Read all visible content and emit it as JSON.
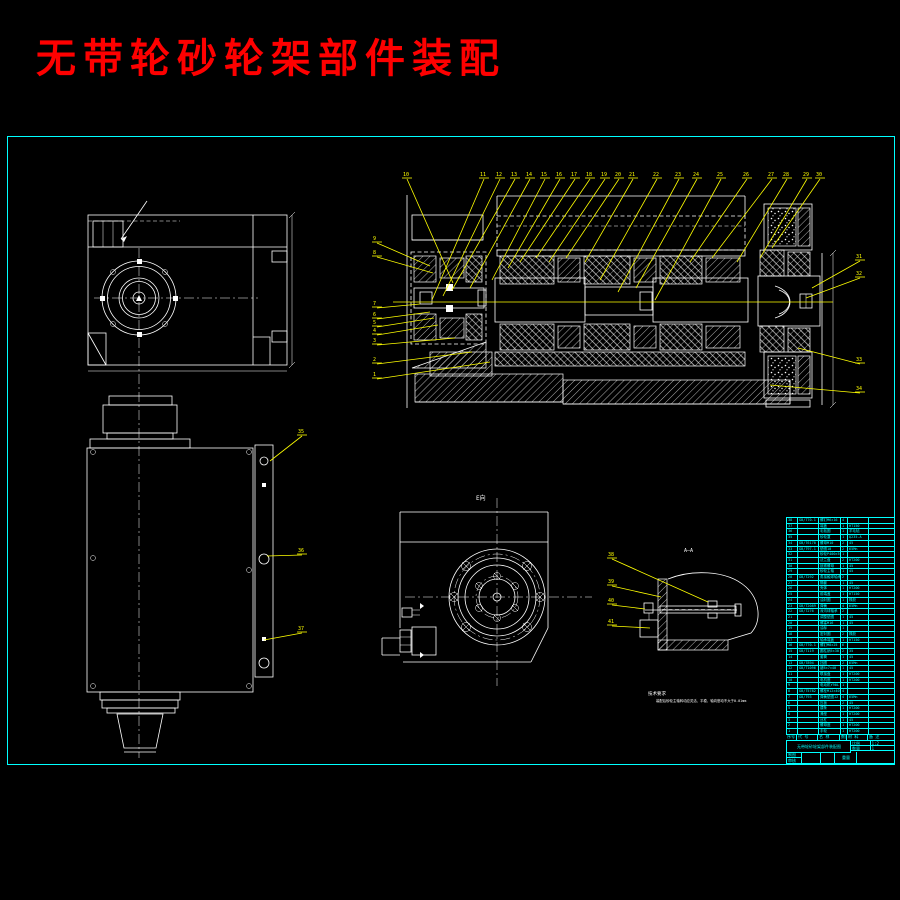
{
  "title": {
    "text": "无带轮砂轮架部件装配"
  },
  "labels": {
    "e_view": "E向",
    "section_aa": "A—A"
  },
  "notes": {
    "heading": "技术要求",
    "body": "装配后砂轮主轴转动应灵活、平稳，轴向窜动不大于0.01mm"
  },
  "colors": {
    "accent": "#ffff00",
    "frame": "#00ffff",
    "line": "#ffffff",
    "title": "#fe0000"
  },
  "bom": {
    "headers": [
      "序号",
      "代 号",
      "名 称",
      "数量",
      "材 料",
      "备 注"
    ],
    "rows": [
      [
        "38",
        "GB/T70.1",
        "螺钉M6×16",
        "4",
        "",
        ""
      ],
      [
        "37",
        "",
        "端盖",
        "1",
        "HT150",
        ""
      ],
      [
        "36",
        "",
        "毛毡圈",
        "1",
        "羊毛毡",
        ""
      ],
      [
        "35",
        "",
        "砂轮罩",
        "1",
        "Q235-A",
        ""
      ],
      [
        "34",
        "GB/T6170",
        "螺母M10",
        "2",
        "45",
        ""
      ],
      [
        "33",
        "GB/T97.1",
        "垫圈10",
        "2",
        "65Mn",
        ""
      ],
      [
        "32",
        "",
        "砂轮P400×50",
        "1",
        "",
        ""
      ],
      [
        "31",
        "",
        "法兰盘",
        "2",
        "HT200",
        ""
      ],
      [
        "30",
        "",
        "锁紧螺母",
        "1",
        "45",
        ""
      ],
      [
        "29",
        "",
        "砂轮主轴",
        "1",
        "45",
        ""
      ],
      [
        "28",
        "GB/T292",
        "角接触球轴承",
        "2",
        "",
        ""
      ],
      [
        "27",
        "",
        "隔套",
        "1",
        "45",
        ""
      ],
      [
        "26",
        "",
        "壳体",
        "1",
        "HT200",
        ""
      ],
      [
        "25",
        "",
        "前端盖",
        "1",
        "HT150",
        ""
      ],
      [
        "24",
        "",
        "油封圈",
        "1",
        "橡胶",
        ""
      ],
      [
        "23",
        "GB/T2089",
        "弹簧",
        "4",
        "65Mn",
        ""
      ],
      [
        "22",
        "GB/T276",
        "深沟球轴承",
        "2",
        "",
        ""
      ],
      [
        "21",
        "",
        "调整垫圈",
        "1",
        "45",
        ""
      ],
      [
        "20",
        "",
        "螺塞M16",
        "1",
        "45",
        ""
      ],
      [
        "19",
        "",
        "油标",
        "1",
        "",
        ""
      ],
      [
        "18",
        "",
        "密封圈",
        "2",
        "橡胶",
        ""
      ],
      [
        "17",
        "",
        "轴承端盖",
        "1",
        "HT150",
        ""
      ],
      [
        "16",
        "GB/T70.1",
        "螺钉M8×25",
        "6",
        "",
        ""
      ],
      [
        "15",
        "GB/T119",
        "圆柱销5×30",
        "2",
        "35",
        ""
      ],
      [
        "14",
        "",
        "套筒",
        "1",
        "45",
        ""
      ],
      [
        "13",
        "GB/T894",
        "挡圈",
        "2",
        "65Mn",
        ""
      ],
      [
        "12",
        "GB/T1096",
        "键8×7×40",
        "1",
        "45",
        ""
      ],
      [
        "11",
        "",
        "联接盘",
        "1",
        "HT200",
        ""
      ],
      [
        "10",
        "",
        "电机座",
        "1",
        "HT200",
        ""
      ],
      [
        "9",
        "",
        "电动机Y90L",
        "1",
        "",
        ""
      ],
      [
        "8",
        "GB/T5782",
        "螺栓M12×40",
        "4",
        "",
        ""
      ],
      [
        "7",
        "GB/T93",
        "弹簧垫圈12",
        "4",
        "65Mn",
        ""
      ],
      [
        "6",
        "",
        "压板",
        "2",
        "45",
        ""
      ],
      [
        "5",
        "",
        "镶条",
        "1",
        "HT200",
        ""
      ],
      [
        "4",
        "",
        "滑座",
        "1",
        "HT200",
        ""
      ],
      [
        "3",
        "",
        "丝杠",
        "1",
        "45",
        ""
      ],
      [
        "2",
        "",
        "螺母座",
        "1",
        "HT200",
        ""
      ],
      [
        "1",
        "",
        "手轮",
        "1",
        "HT200",
        ""
      ]
    ],
    "title_block": {
      "title": "无带轮砂轮架部件装配图",
      "scale_label": "比例",
      "scale": "1:2",
      "qty_label": "数量",
      "qty": "1",
      "weight_label": "重量",
      "draw_label": "制图",
      "check_label": "审核"
    }
  },
  "balloons": [
    {
      "n": "10",
      "lx": 403,
      "ly": 176,
      "tx": 453,
      "ty": 283
    },
    {
      "n": "11",
      "lx": 480,
      "ly": 176,
      "tx": 432,
      "ty": 300
    },
    {
      "n": "12",
      "lx": 496,
      "ly": 176,
      "tx": 443,
      "ty": 296
    },
    {
      "n": "13",
      "lx": 511,
      "ly": 176,
      "tx": 452,
      "ty": 290
    },
    {
      "n": "14",
      "lx": 526,
      "ly": 176,
      "tx": 470,
      "ty": 288
    },
    {
      "n": "15",
      "lx": 541,
      "ly": 176,
      "tx": 492,
      "ty": 280
    },
    {
      "n": "16",
      "lx": 556,
      "ly": 176,
      "tx": 508,
      "ty": 268
    },
    {
      "n": "17",
      "lx": 571,
      "ly": 176,
      "tx": 520,
      "ty": 262
    },
    {
      "n": "18",
      "lx": 586,
      "ly": 176,
      "tx": 536,
      "ty": 258
    },
    {
      "n": "19",
      "lx": 601,
      "ly": 176,
      "tx": 549,
      "ty": 262
    },
    {
      "n": "20",
      "lx": 615,
      "ly": 176,
      "tx": 566,
      "ty": 258
    },
    {
      "n": "21",
      "lx": 629,
      "ly": 176,
      "tx": 585,
      "ty": 262
    },
    {
      "n": "22",
      "lx": 653,
      "ly": 176,
      "tx": 600,
      "ty": 280
    },
    {
      "n": "23",
      "lx": 675,
      "ly": 176,
      "tx": 618,
      "ty": 292
    },
    {
      "n": "24",
      "lx": 693,
      "ly": 176,
      "tx": 636,
      "ty": 288
    },
    {
      "n": "25",
      "lx": 717,
      "ly": 176,
      "tx": 655,
      "ty": 300
    },
    {
      "n": "26",
      "lx": 743,
      "ly": 176,
      "tx": 690,
      "ty": 262
    },
    {
      "n": "27",
      "lx": 768,
      "ly": 176,
      "tx": 712,
      "ty": 258
    },
    {
      "n": "28",
      "lx": 783,
      "ly": 176,
      "tx": 737,
      "ty": 262
    },
    {
      "n": "29",
      "lx": 803,
      "ly": 176,
      "tx": 760,
      "ty": 258
    },
    {
      "n": "30",
      "lx": 816,
      "ly": 176,
      "tx": 772,
      "ty": 248
    },
    {
      "n": "9",
      "lx": 373,
      "ly": 240,
      "tx": 430,
      "ty": 266
    },
    {
      "n": "8",
      "lx": 373,
      "ly": 254,
      "tx": 433,
      "ty": 273
    },
    {
      "n": "7",
      "lx": 373,
      "ly": 305,
      "tx": 420,
      "ty": 304
    },
    {
      "n": "6",
      "lx": 373,
      "ly": 316,
      "tx": 430,
      "ty": 312
    },
    {
      "n": "5",
      "lx": 373,
      "ly": 324,
      "tx": 434,
      "ty": 318
    },
    {
      "n": "4",
      "lx": 373,
      "ly": 332,
      "tx": 438,
      "ty": 325
    },
    {
      "n": "3",
      "lx": 373,
      "ly": 342,
      "tx": 455,
      "ty": 338
    },
    {
      "n": "2",
      "lx": 373,
      "ly": 361,
      "tx": 472,
      "ty": 352
    },
    {
      "n": "1",
      "lx": 373,
      "ly": 376,
      "tx": 490,
      "ty": 362
    },
    {
      "n": "31",
      "lx": 856,
      "ly": 258,
      "tx": 812,
      "ty": 288
    },
    {
      "n": "32",
      "lx": 856,
      "ly": 275,
      "tx": 806,
      "ty": 298
    },
    {
      "n": "33",
      "lx": 856,
      "ly": 361,
      "tx": 798,
      "ty": 348
    },
    {
      "n": "34",
      "lx": 856,
      "ly": 390,
      "tx": 770,
      "ty": 385
    },
    {
      "n": "35",
      "lx": 298,
      "ly": 433,
      "tx": 270,
      "ty": 461
    },
    {
      "n": "36",
      "lx": 298,
      "ly": 552,
      "tx": 267,
      "ty": 556
    },
    {
      "n": "37",
      "lx": 298,
      "ly": 630,
      "tx": 264,
      "ty": 640
    },
    {
      "n": "38",
      "lx": 608,
      "ly": 556,
      "tx": 708,
      "ty": 602
    },
    {
      "n": "39",
      "lx": 608,
      "ly": 583,
      "tx": 661,
      "ty": 597
    },
    {
      "n": "40",
      "lx": 608,
      "ly": 602,
      "tx": 645,
      "ty": 609
    },
    {
      "n": "41",
      "lx": 608,
      "ly": 623,
      "tx": 650,
      "ty": 628
    }
  ]
}
